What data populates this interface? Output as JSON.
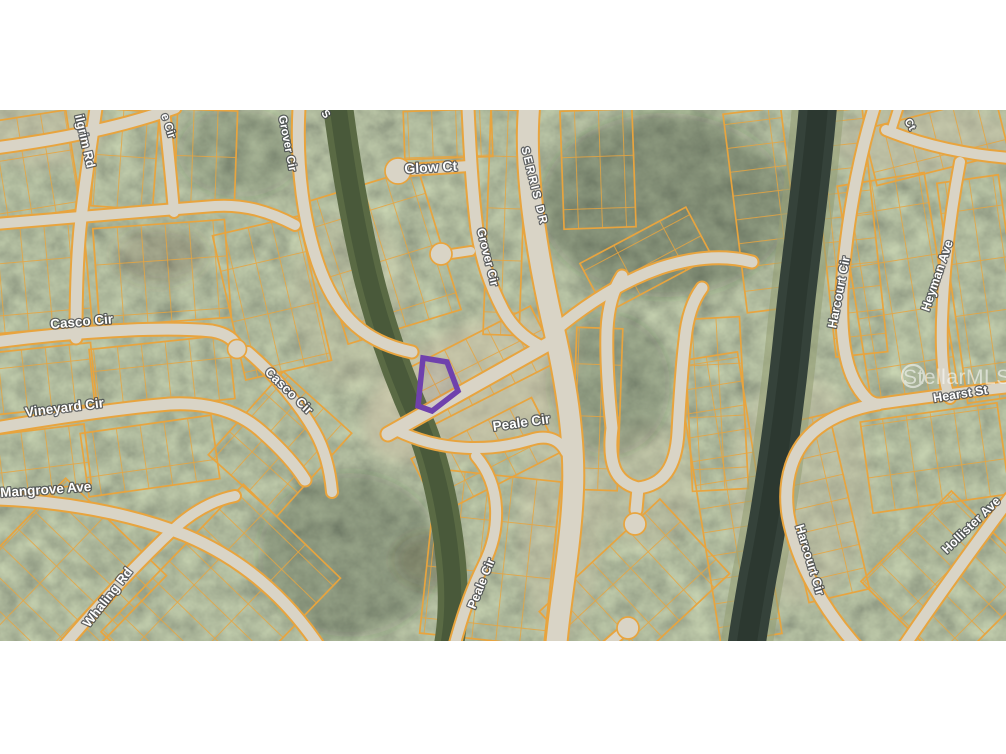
{
  "page": {
    "background": "#ffffff",
    "type": "mls-listing-aerial-parcel-map"
  },
  "map": {
    "watermark": {
      "text": "StellarMLS"
    },
    "highlighted_lot": {
      "name": "subject-lot",
      "outline_color": "#6f41ad"
    },
    "colors": {
      "parcel_lines": "#e8a43e",
      "roads": "#d9d4c6",
      "vegetation": "#6b7a55",
      "water_canal": "#35423a",
      "highlight": "#6f41ad",
      "margin": "#ffffff"
    },
    "street_labels": [
      {
        "text": "Glow Ct"
      },
      {
        "text": "Grover Cir"
      },
      {
        "text": "S"
      },
      {
        "text": "e Cir"
      },
      {
        "text": "ilgrim Rd"
      },
      {
        "text": "SERRIS DR"
      },
      {
        "text": "Grover Cir"
      },
      {
        "text": "Casco Cir"
      },
      {
        "text": "Casco Cir"
      },
      {
        "text": "Vineyard Cir"
      },
      {
        "text": "Mangrove Ave"
      },
      {
        "text": "Whaling Rd"
      },
      {
        "text": "Peale Cir"
      },
      {
        "text": "Peale Cir"
      },
      {
        "text": "Ct"
      },
      {
        "text": "Harcourt Cir"
      },
      {
        "text": "Heyman Ave"
      },
      {
        "text": "Hearst St"
      },
      {
        "text": "Harcourt Cir"
      },
      {
        "text": "Hollister Ave"
      }
    ]
  }
}
